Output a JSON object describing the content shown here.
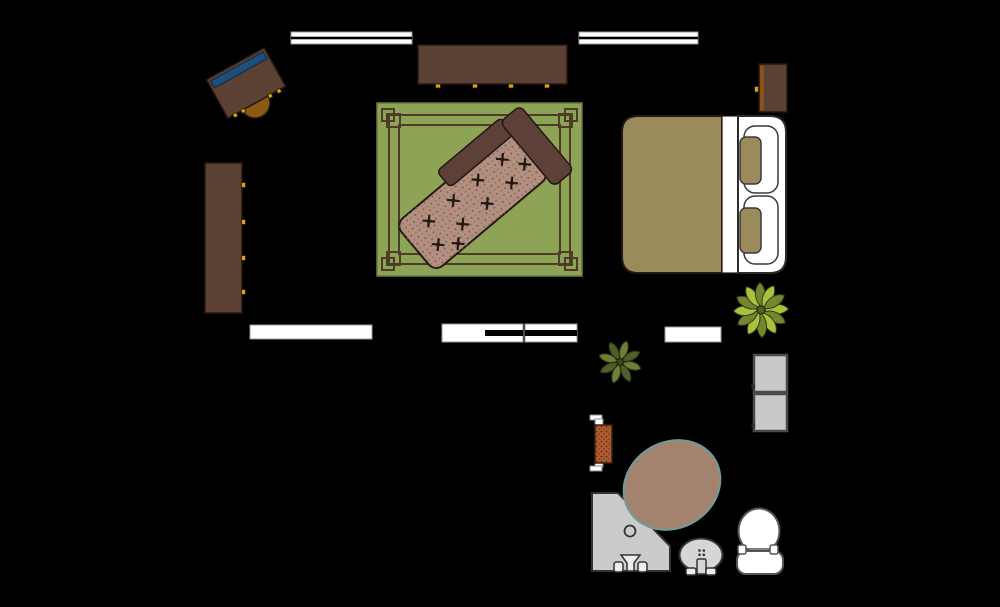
{
  "scene": {
    "type": "floor-plan",
    "title": "Bedroom with en-suite bathroom floor plan",
    "background": "#000000",
    "canvas": {
      "width": 1000,
      "height": 607
    }
  },
  "palette": {
    "background": "#000000",
    "wood_brown": "#5a4134",
    "dark_outline": "#241812",
    "knob_yellow": "#d9a70c",
    "laptop_blue": "#1d4f7c",
    "chair_brown": "#8a5a10",
    "rug_green": "#8da355",
    "rug_border_brown": "#4e3b28",
    "chaise_upholstery_pink": "#b28f7e",
    "chaise_wood_brown": "#5d4037",
    "bed_khaki": "#9b8b5c",
    "fixture_white": "#ffffff",
    "fixture_gray": "#cbcbcb",
    "bathtub_fill": "#a3836e",
    "bathtub_outline": "#6f9b9b",
    "radiator_rust": "#ad5a2e",
    "plant_light_green": "#a9c23d",
    "plant_olive_green": "#76862f",
    "plant_small_green": "#6f7f36"
  },
  "objects": [
    {
      "name": "window-top-left",
      "label": "Window (double line)",
      "x": 291,
      "y": 32,
      "w": 121,
      "h": 12
    },
    {
      "name": "window-top-right",
      "label": "Window (double line)",
      "x": 579,
      "y": 32,
      "w": 119,
      "h": 12
    },
    {
      "name": "door-opening-left",
      "label": "Door opening",
      "x": 250,
      "y": 325,
      "w": 122,
      "h": 14
    },
    {
      "name": "sliding-door-bottom",
      "label": "Sliding door",
      "x": 442,
      "y": 324,
      "w": 81,
      "h": 18
    },
    {
      "name": "window-bottom",
      "label": "Window (double line)",
      "x": 525,
      "y": 324,
      "w": 52,
      "h": 18
    },
    {
      "name": "door-bathroom",
      "label": "Bathroom door opening",
      "x": 665,
      "y": 327,
      "w": 56,
      "h": 15
    },
    {
      "name": "desk",
      "label": "Desk with laptop",
      "cx": 246,
      "cy": 83,
      "w": 66,
      "h": 44,
      "rotation_deg": -29
    },
    {
      "name": "desk-chair",
      "label": "Half-round desk stool",
      "cx": 255,
      "cy": 103,
      "r": 15,
      "rotation_deg": -29
    },
    {
      "name": "wardrobe",
      "label": "Tall wardrobe, 4 knobs",
      "x": 205,
      "y": 163,
      "w": 37,
      "h": 150
    },
    {
      "name": "dresser",
      "label": "Low dresser, 4 knobs",
      "x": 418,
      "y": 45,
      "w": 149,
      "h": 39
    },
    {
      "name": "nightstand",
      "label": "Nightstand with knob",
      "x": 759,
      "y": 64,
      "w": 28,
      "h": 48
    },
    {
      "name": "bed",
      "label": "Double bed with two pillows",
      "x": 622,
      "y": 116,
      "w": 164,
      "h": 157
    },
    {
      "name": "rug",
      "label": "Green bordered area rug",
      "x": 377,
      "y": 103,
      "w": 205,
      "h": 173
    },
    {
      "name": "chaise-lounge",
      "label": "Tufted chaise lounge",
      "cx": 481,
      "cy": 193,
      "w": 172,
      "h": 62,
      "rotation_deg": -40
    },
    {
      "name": "plant-large",
      "label": "Potted plant (large)",
      "cx": 761,
      "cy": 310,
      "r": 27
    },
    {
      "name": "plant-small",
      "label": "Potted plant (small)",
      "cx": 620,
      "cy": 362,
      "r": 21
    },
    {
      "name": "towel-radiator",
      "label": "Wall towel radiator",
      "x": 595,
      "y": 425,
      "w": 17,
      "h": 38
    },
    {
      "name": "bathtub",
      "label": "Oval bathtub",
      "cx": 672,
      "cy": 485,
      "rx": 50,
      "ry": 43,
      "rotation_deg": -30
    },
    {
      "name": "corner-shower",
      "label": "Corner shower with drain and taps",
      "x": 592,
      "y": 493,
      "w": 78,
      "h": 79
    },
    {
      "name": "pedestal-sink",
      "label": "Pedestal sink",
      "cx": 701,
      "cy": 555,
      "rx": 21,
      "ry": 16
    },
    {
      "name": "toilet",
      "label": "Toilet with tank",
      "x": 737,
      "y": 509,
      "w": 46,
      "h": 65
    },
    {
      "name": "cabinet-upper",
      "label": "Gray cabinet / appliance",
      "x": 754,
      "y": 355,
      "w": 33,
      "h": 37
    },
    {
      "name": "cabinet-lower",
      "label": "Gray cabinet / appliance",
      "x": 754,
      "y": 394,
      "w": 33,
      "h": 37
    }
  ]
}
